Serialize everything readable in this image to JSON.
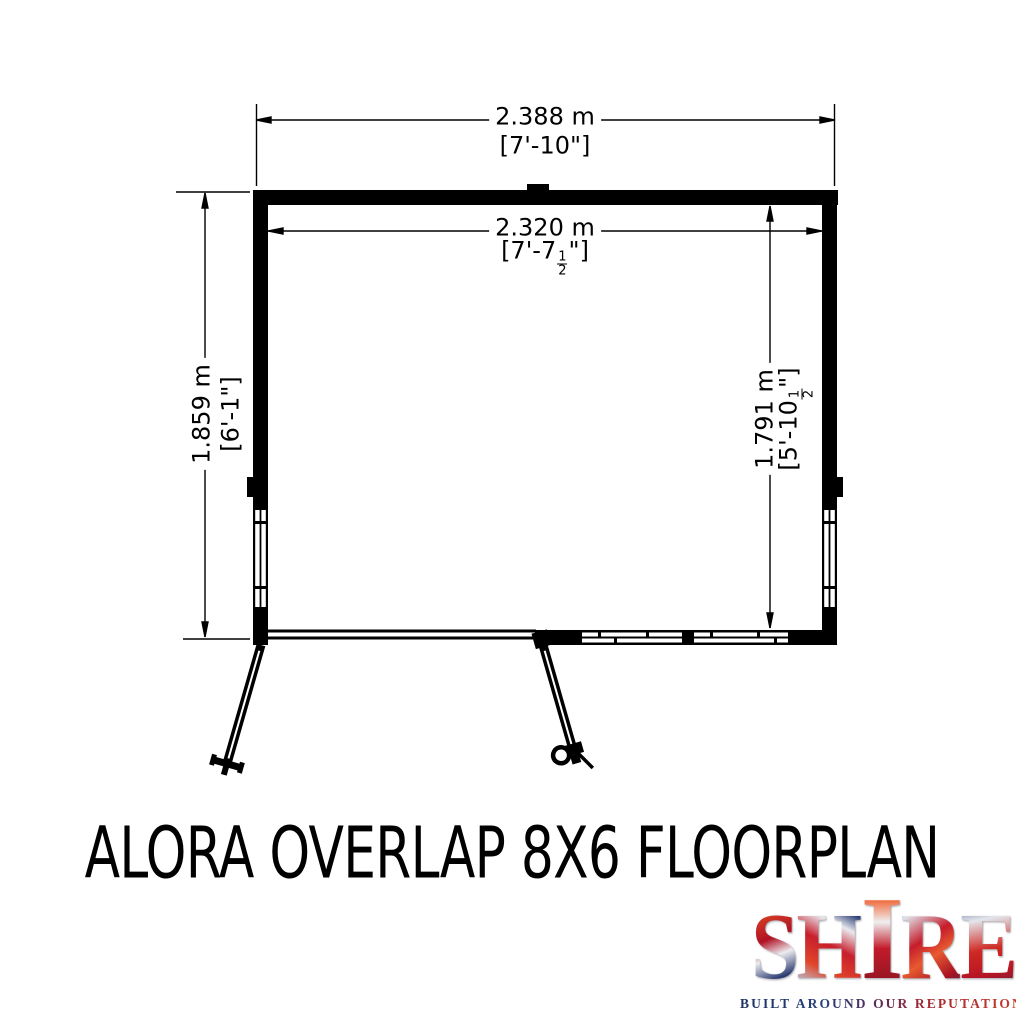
{
  "page": {
    "background": "#ffffff",
    "line_color": "#000000"
  },
  "title": "ALORA OVERLAP 8X6 FLOORPLAN",
  "floorplan": {
    "dimensions": {
      "outer_width": {
        "metric": "2.388 m",
        "imperial": "[7'-10\"]"
      },
      "inner_width": {
        "metric": "2.320 m",
        "imperial_pre": "[7'-7",
        "frac_num": "1",
        "frac_den": "2",
        "imperial_post": "\"]"
      },
      "outer_depth": {
        "metric": "1.859 m",
        "imperial": "[6'-1\"]"
      },
      "inner_depth": {
        "metric": "1.791 m",
        "imperial_pre": "[5'-10",
        "frac_num": "1",
        "frac_den": "2",
        "imperial_post": "\"]"
      }
    }
  },
  "logo": {
    "brand_letters": [
      "S",
      "H",
      "I",
      "R",
      "E"
    ],
    "tagline": "BUILT AROUND OUR REPUTATION",
    "colors": {
      "flag_red": "#c8102e",
      "flag_blue": "#1f2f63",
      "flag_white": "#e9ebf0",
      "tagline_navy": "#1e3160",
      "tagline_red": "#c23b2b"
    }
  }
}
